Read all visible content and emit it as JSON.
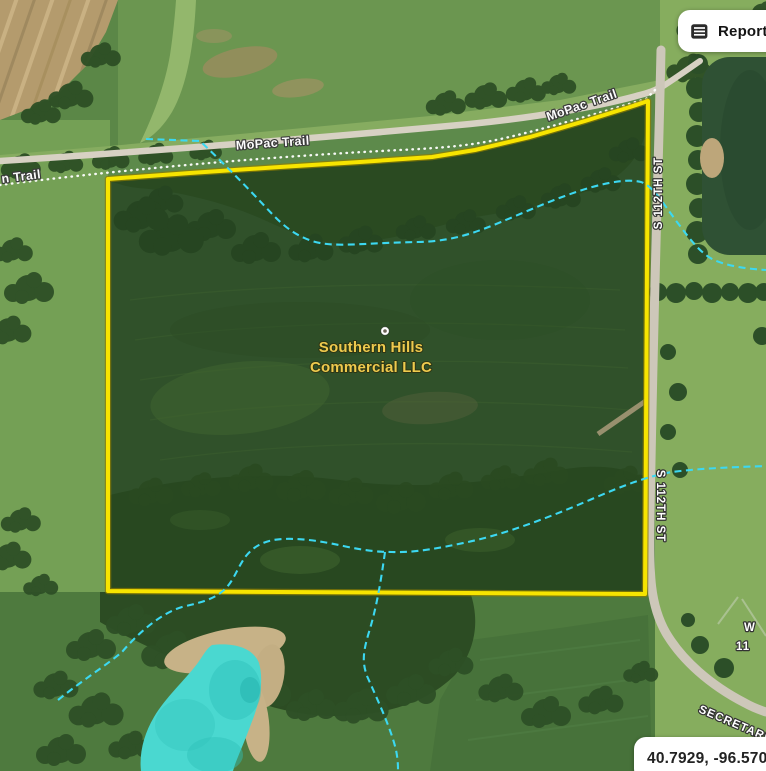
{
  "header": {
    "reports_button": {
      "label": "Reports",
      "icon": "report-document-icon"
    }
  },
  "map": {
    "parcel": {
      "name_line1": "Southern Hills",
      "name_line2": "Commercial LLC"
    },
    "labels": {
      "trail_left_partial": "n Trail",
      "trail_mid": "MoPac Trail",
      "trail_right": "MoPac Trail",
      "street_upper": "S 112TH ST",
      "street_lower": "S 112TH ST",
      "street_secretariat": "SECRETARIA",
      "edge_partial_line1": "W",
      "edge_partial_line2": "11"
    },
    "coordinate_readout": "40.7929, -96.5703",
    "colors": {
      "parcel_outline": "#f7e400",
      "parcel_label_text": "#eeca4e",
      "stream_line": "#3cd8f1",
      "pond_highlight": "#4ad8d0",
      "trail_dotted": "#ffffff",
      "road_label_fill": "#ffffff"
    }
  }
}
